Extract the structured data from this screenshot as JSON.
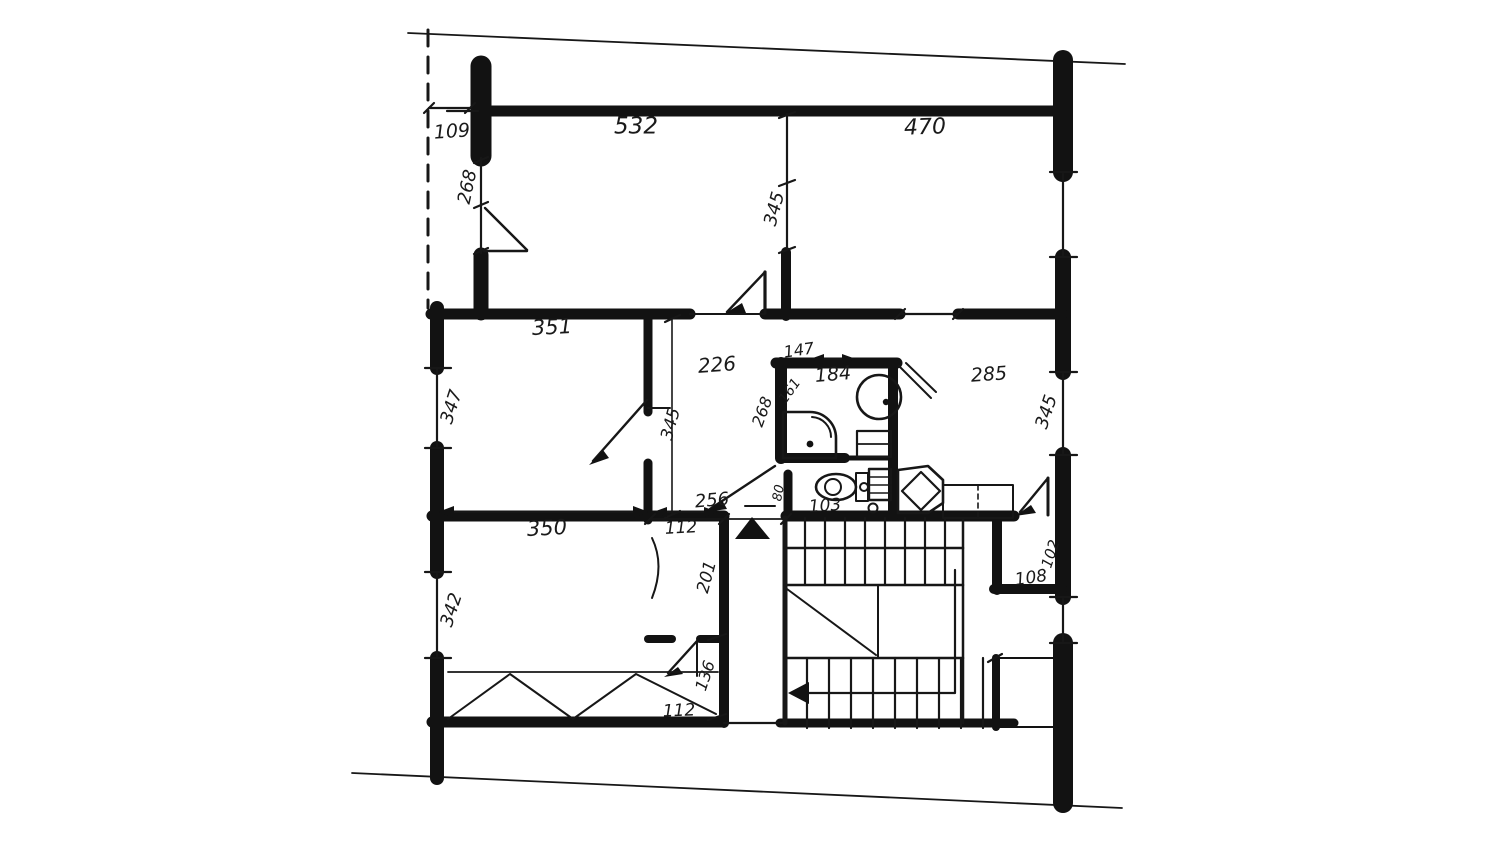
{
  "document": {
    "kind": "hand-drawn floor plan sketch",
    "background_color": "#ffffff",
    "ink_color": "#171717"
  },
  "dimension_labels": [
    {
      "text": "109",
      "x": 452,
      "y": 132,
      "rot": -4,
      "size": 19
    },
    {
      "text": "532",
      "x": 636,
      "y": 127,
      "rot": 0,
      "size": 23
    },
    {
      "text": "470",
      "x": 925,
      "y": 128,
      "rot": -2,
      "size": 22
    },
    {
      "text": "268",
      "x": 468,
      "y": 187,
      "rot": -78,
      "size": 18
    },
    {
      "text": "345",
      "x": 775,
      "y": 209,
      "rot": -75,
      "size": 18
    },
    {
      "text": "351",
      "x": 552,
      "y": 328,
      "rot": -3,
      "size": 21
    },
    {
      "text": "347",
      "x": 452,
      "y": 407,
      "rot": -72,
      "size": 18
    },
    {
      "text": "226",
      "x": 717,
      "y": 366,
      "rot": -4,
      "size": 20
    },
    {
      "text": "345",
      "x": 671,
      "y": 424,
      "rot": -75,
      "size": 17
    },
    {
      "text": "147",
      "x": 799,
      "y": 351,
      "rot": -8,
      "size": 16
    },
    {
      "text": "184",
      "x": 833,
      "y": 375,
      "rot": -5,
      "size": 19
    },
    {
      "text": "268",
      "x": 763,
      "y": 412,
      "rot": -70,
      "size": 16
    },
    {
      "text": "161",
      "x": 790,
      "y": 391,
      "rot": -55,
      "size": 14
    },
    {
      "text": "285",
      "x": 989,
      "y": 375,
      "rot": -4,
      "size": 19
    },
    {
      "text": "345",
      "x": 1047,
      "y": 412,
      "rot": -72,
      "size": 18
    },
    {
      "text": "350",
      "x": 547,
      "y": 529,
      "rot": -3,
      "size": 21
    },
    {
      "text": "256",
      "x": 712,
      "y": 501,
      "rot": -5,
      "size": 18
    },
    {
      "text": "112",
      "x": 681,
      "y": 528,
      "rot": -3,
      "size": 17
    },
    {
      "text": "80",
      "x": 779,
      "y": 493,
      "rot": -80,
      "size": 13
    },
    {
      "text": "103",
      "x": 825,
      "y": 506,
      "rot": -4,
      "size": 17
    },
    {
      "text": "201",
      "x": 707,
      "y": 577,
      "rot": -75,
      "size": 17
    },
    {
      "text": "342",
      "x": 452,
      "y": 610,
      "rot": -72,
      "size": 18
    },
    {
      "text": "136",
      "x": 706,
      "y": 676,
      "rot": -72,
      "size": 16
    },
    {
      "text": "112",
      "x": 679,
      "y": 711,
      "rot": -2,
      "size": 17
    },
    {
      "text": "108",
      "x": 1031,
      "y": 578,
      "rot": -8,
      "size": 17
    },
    {
      "text": "102",
      "x": 1051,
      "y": 554,
      "rot": -72,
      "size": 15
    }
  ],
  "fixtures": [
    "shower-stall",
    "round-washbasin",
    "toilet",
    "cistern-shelf",
    "washing-machine",
    "corner-basin",
    "cabinet",
    "wardrobe-zigzag",
    "staircase",
    "entrance-marker-triangle"
  ],
  "annotations": {
    "entrance_marker": "filled triangle at flat entry",
    "stair_direction": "arrow pointing left on lower flight",
    "boundary": "slanted section lines top and bottom, dashed loggia line at left"
  }
}
